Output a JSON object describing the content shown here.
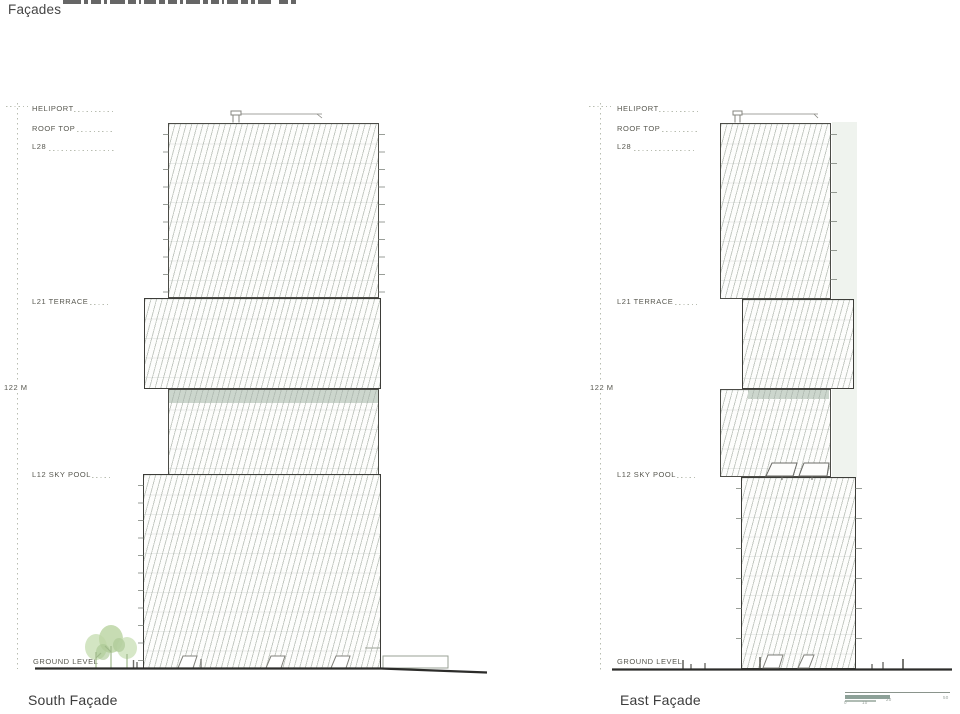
{
  "title": "Façades",
  "levels": {
    "heliport": "HELIPORT",
    "roof_top": "ROOF TOP",
    "l28": "L28",
    "l21_terrace": "L21 TERRACE",
    "height_mark": "122 M",
    "l12_sky_pool": "L12 SKY POOL",
    "ground_level": "GROUND LEVEL"
  },
  "captions": {
    "south": "South Façade",
    "east": "East Façade"
  },
  "scalebar": {
    "ticks": [
      "0",
      "10",
      "20",
      "50"
    ]
  },
  "colors": {
    "hatch": "#c2c8c1",
    "band": "#ccd6cd",
    "strip": "#eff3ee",
    "ink": "#4c4c47",
    "label": "#57574f",
    "dots": "#b8bdb1",
    "ground": "#2c2c2a"
  }
}
